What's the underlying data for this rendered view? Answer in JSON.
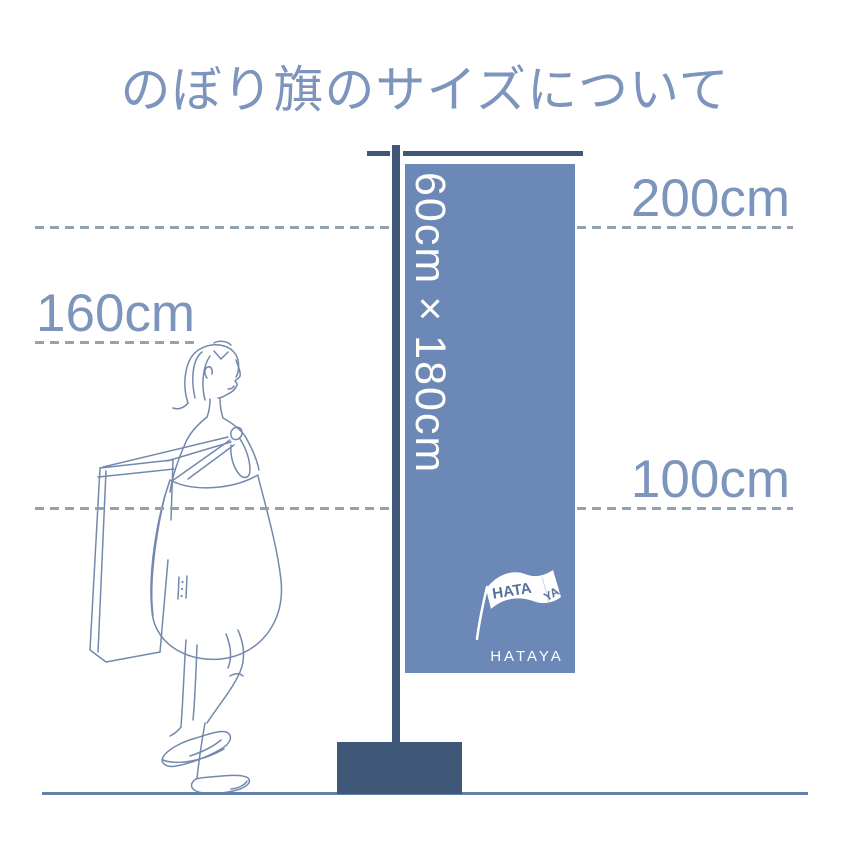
{
  "title": "のぼり旗のサイズについて",
  "flag": {
    "size_text": "60cm×180cm",
    "logo": {
      "mark_line1": "HATA",
      "mark_line2": "YA",
      "brand": "HATAYA"
    }
  },
  "measurements": {
    "h200": "200cm",
    "h160": "160cm",
    "h100": "100cm"
  },
  "colors": {
    "flag_blue": "#6b88b6",
    "pole_dark": "#3f5878",
    "label_blue": "#7d95bc",
    "dash_gray": "#93a2b1",
    "ground_blue": "#6381a9",
    "sketch_stroke": "#7289ad",
    "logo_text_blue": "#56719c",
    "flag_text_white": "#ffffff"
  }
}
